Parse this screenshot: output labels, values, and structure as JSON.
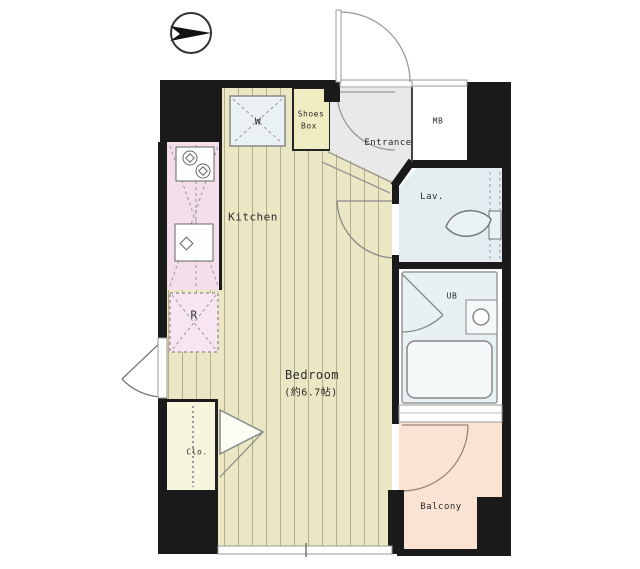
{
  "floor_plan": {
    "compass": {
      "icon": "north-arrow"
    },
    "rooms": {
      "kitchen": {
        "label": "Kitchen"
      },
      "bedroom": {
        "label": "Bedroom",
        "area": "(約6.7帖)"
      },
      "entrance": {
        "label": "Entrance"
      },
      "shoes_box": {
        "label_line1": "Shoes",
        "label_line2": "Box"
      },
      "meter_box": {
        "label": "MB"
      },
      "lavatory": {
        "label": "Lav."
      },
      "unit_bath": {
        "label": "UB"
      },
      "balcony": {
        "label": "Balcony"
      },
      "closet": {
        "label": "Clo."
      },
      "refrigerator_space": {
        "label": "R"
      },
      "washing_machine": {
        "label": "W"
      }
    },
    "colors": {
      "wall": "#1a1a1a",
      "wood_floor": "#ebe7c4",
      "wood_stripe": "#b3ae8c",
      "kitchen_pink": "#f5deeb",
      "water_blue": "#e4eef1",
      "balcony_peach": "#fbe3d4",
      "shoes_box_yellow": "#f0ecc2",
      "closet_cream": "#f7f4dc",
      "entrance_gray": "#e9e9ec"
    }
  }
}
